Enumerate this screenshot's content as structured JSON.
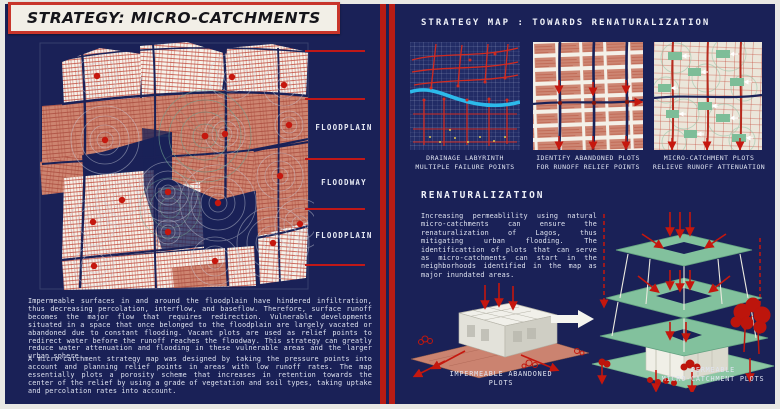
{
  "title": "STRATEGY: MICRO-CATCHMENTS",
  "left_panel": {
    "zone_labels": [
      "FLOODPLAIN",
      "FLOODWAY",
      "FLOODPLAIN"
    ],
    "paragraphs": [
      "Impermeable surfaces in and around the floodplain have hindered infiltration, thus decreasing percolation, interflow, and baseflow. Therefore, surface runoff becomes the major flow that requires redirection. Vulnerable developments situated in a space that once belonged to the floodplain are largely vacated or abandoned due to constant flooding. Vacant plots are used as relief points to redirect water before the runoff reaches the floodway. This strategy can greatly reduce water attenuation and flooding in these vulnerable areas and the larger urban sphere.",
      "A micro-catchment strategy map was designed by taking the pressure points into account and planning relief points in areas with low runoff rates. The map essentially plots a porosity scheme that increases in retention towards the center of the relief by using a grade of vegetation and soil types, taking uptake and percolation rates into account."
    ]
  },
  "right_panel": {
    "heading": "STRATEGY MAP : TOWARDS RENATURALIZATION",
    "map_captions": [
      {
        "line1": "DRAINAGE LABYRINTH",
        "line2": "MULTIPLE FAILURE POINTS"
      },
      {
        "line1": "IDENTIFY ABANDONED PLOTS",
        "line2": "FOR RUNOFF RELIEF POINTS"
      },
      {
        "line1": "MICRO-CATCHMENT PLOTS",
        "line2": "RELIEVE RUNOFF ATTENUATION"
      }
    ],
    "renaturalization_heading": "RENATURALIZATION",
    "renaturalization_paragraph": "Increasing permeablility using natural micro-catchments can ensure the renaturalization of Lagos, thus mitigating urban flooding. The identificattion of plots that can serve as micro-catchments can start in the neighborhoods identified in the map as major inundated areas.",
    "diagram_left_label": {
      "line1": "IMPERMEABLE ABANDONED",
      "line2": "PLOTS"
    },
    "diagram_right_label": {
      "line1": "PERMEABLE",
      "line2": "MICRO-CATCHMENT PLOTS"
    }
  },
  "colors": {
    "board_navy": "#1a2157",
    "accent_red": "#c5170e",
    "line_red": "#c01818",
    "salmon": "#cd8673",
    "mint_green": "#82c19d",
    "river_cyan": "#2cb9ea",
    "paper_cream": "#f2efe7"
  }
}
